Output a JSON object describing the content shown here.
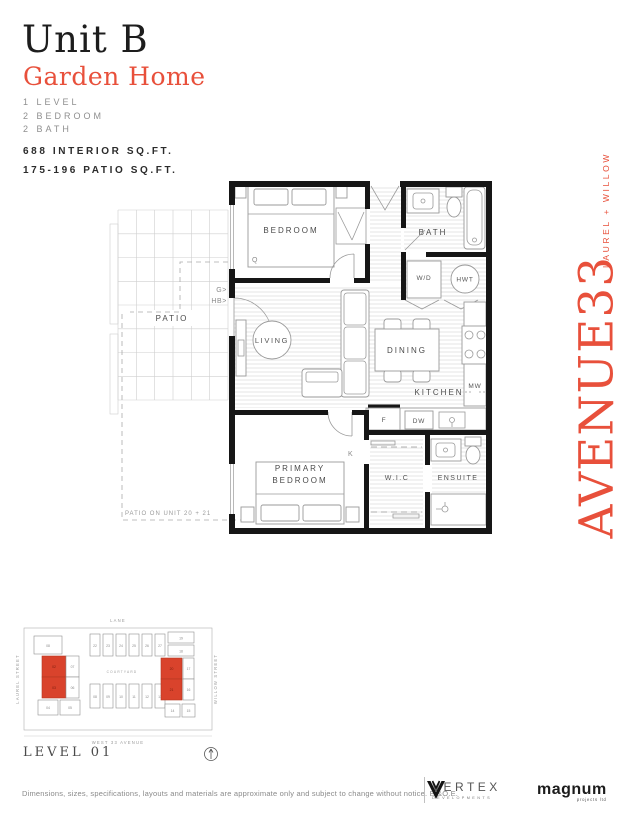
{
  "accent_color": "#E8503B",
  "siteplan_highlight_color": "#D9432C",
  "header": {
    "unit_title": "Unit B",
    "unit_subtitle": "Garden Home",
    "spec_level": "1  LEVEL",
    "spec_bedroom": "2  BEDROOM",
    "spec_bath": "2  BATH",
    "interior_sqft": "688 INTERIOR SQ.FT.",
    "patio_sqft": "175-196 PATIO SQ.FT."
  },
  "floorplan": {
    "labels": {
      "bedroom": "BEDROOM",
      "bedroom_bed": "Q",
      "bath": "BATH",
      "washer_dryer": "W/D",
      "hot_water_tank": "HWT",
      "patio": "PATIO",
      "gas": "G>",
      "hose_bib": "HB>",
      "living": "LIVING",
      "dining": "DINING",
      "kitchen": "KITCHEN",
      "microwave": "MW",
      "fridge": "F",
      "dishwasher": "DW",
      "primary_line1": "PRIMARY",
      "primary_line2": "BEDROOM",
      "primary_bed": "K",
      "wic": "W.I.C",
      "ensuite": "ENSUITE",
      "patio_note": "PATIO ON UNIT 20 + 21"
    }
  },
  "brand": {
    "property_line": "LAUREL + WILLOW",
    "property_name": "AVENUE33"
  },
  "siteplan": {
    "street_top": "LANE",
    "street_left": "LAUREL STREET",
    "street_right": "WILLOW STREET",
    "street_bottom": "WEST 33 AVENUE",
    "courtyard": "COURTYARD",
    "level_label": "LEVEL 01",
    "highlighted_units": [
      "02",
      "03",
      "20",
      "21"
    ],
    "units_left": [
      "08",
      "02",
      "07",
      "03",
      "06",
      "04",
      "05"
    ],
    "units_top": [
      "22",
      "23",
      "24",
      "25",
      "26",
      "27"
    ],
    "units_bottom": [
      "08",
      "09",
      "10",
      "11",
      "12",
      "13"
    ],
    "units_right": [
      "19",
      "18",
      "20",
      "17",
      "21",
      "16",
      "14",
      "15"
    ]
  },
  "footer": {
    "disclaimer": "Dimensions, sizes, specifications, layouts and materials are approximate only and subject to change without notice. E.&O.E.",
    "vertex_name": "VERTEX",
    "vertex_sub": "DEVELOPMENTS",
    "magnum_name": "magnum",
    "magnum_sub": "projects ltd"
  }
}
